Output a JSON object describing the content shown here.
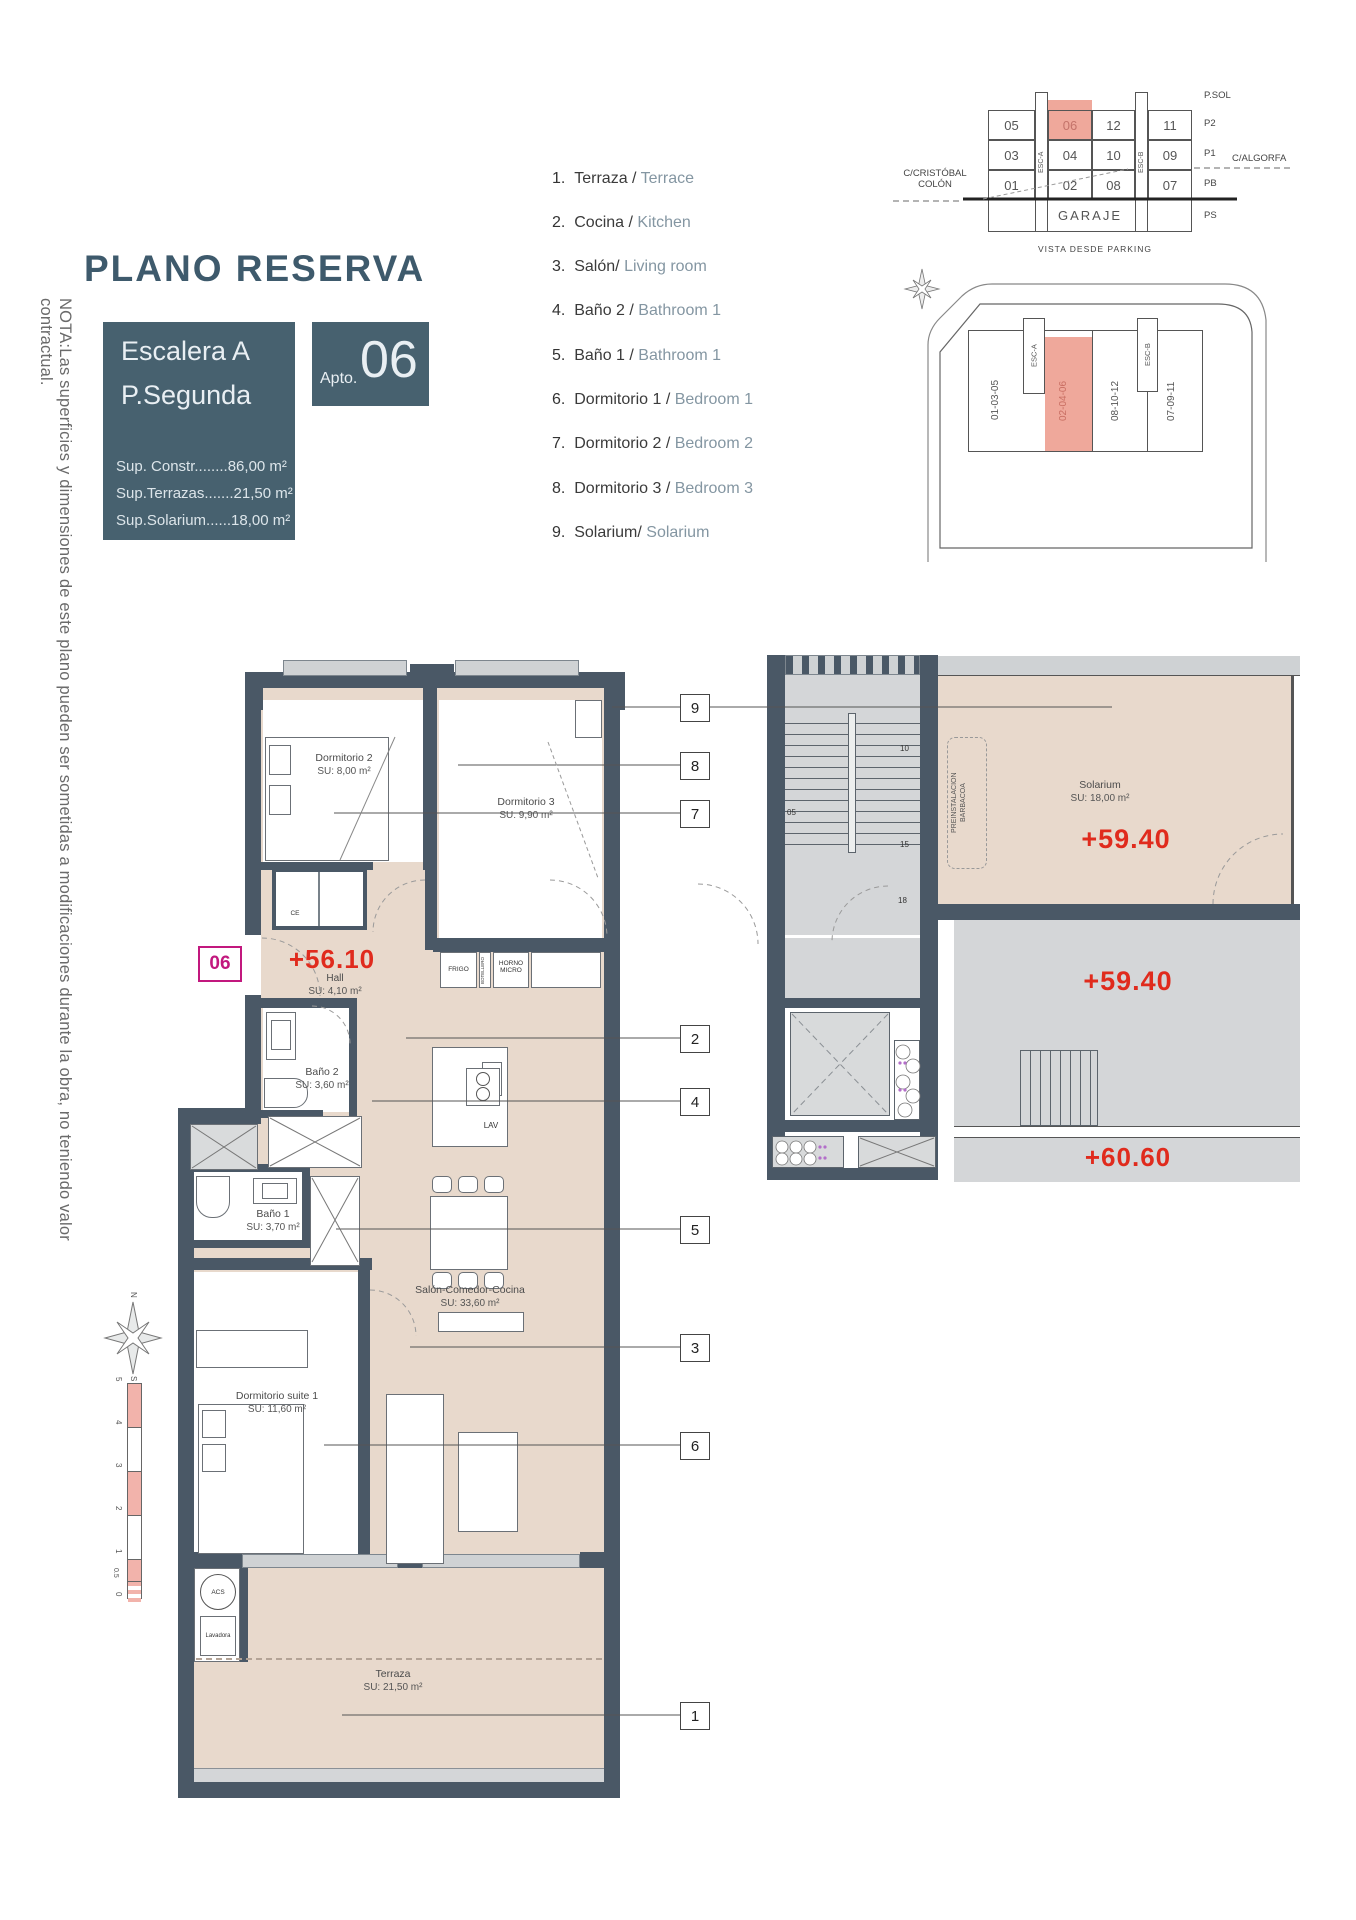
{
  "header": {
    "title": "PLANO RESERVA",
    "stair_block": {
      "line1": "Escalera A",
      "line2": "P.Segunda"
    },
    "apto": {
      "label": "Apto.",
      "number": "06"
    },
    "areas": [
      "Sup. Constr........86,00 m²",
      "Sup.Terrazas.......21,50 m²",
      "Sup.Solarium......18,00 m²"
    ]
  },
  "legend": {
    "items": [
      {
        "num": "1.",
        "es": "Terraza /",
        "en": "Terrace"
      },
      {
        "num": "2.",
        "es": "Cocina /",
        "en": "Kitchen"
      },
      {
        "num": "3.",
        "es": "Salón/",
        "en": "Living room"
      },
      {
        "num": "4.",
        "es": "Baño 2 /",
        "en": "Bathroom 1"
      },
      {
        "num": "5.",
        "es": "Baño 1 /",
        "en": "Bathroom 1"
      },
      {
        "num": "6.",
        "es": "Dormitorio 1 /",
        "en": "Bedroom 1"
      },
      {
        "num": "7.",
        "es": "Dormitorio 2 /",
        "en": "Bedroom 2"
      },
      {
        "num": "8.",
        "es": "Dormitorio 3 /",
        "en": "Bedroom 3"
      },
      {
        "num": "9.",
        "es": "Solarium/",
        "en": "Solarium"
      }
    ]
  },
  "parking": {
    "caption": "VISTA DESDE PARKING",
    "garage": "GARAJE",
    "esc_a": "ESC-A",
    "esc_b": "ESC-B",
    "floors": [
      "P.SOL",
      "P2",
      "P1",
      "PB",
      "PS"
    ],
    "street_left": "C/CRISTÓBAL COLÓN",
    "street_right": "C/ALGORFA",
    "rows": [
      [
        "05",
        "06",
        "12",
        "11"
      ],
      [
        "03",
        "04",
        "10",
        "09"
      ],
      [
        "01",
        "02",
        "08",
        "07"
      ]
    ],
    "highlighted_unit": "06"
  },
  "site": {
    "blocks": [
      "01-03-05",
      "02-04-06",
      "08-10-12",
      "07-09-11"
    ],
    "esc_a": "ESC-A",
    "esc_b": "ESC-B",
    "highlighted_block": "02-04-06"
  },
  "note": "NOTA:Las superficies y dimensiones de este plano pueden ser sometidas a modificaciones durante la obra, no teniendo valor contractual.",
  "plan": {
    "unit_badge": "06",
    "levels": {
      "hall": "+56.10",
      "solarium": "+59.40",
      "upper_terrace": "+59.40",
      "stair_top": "+60.60"
    },
    "rooms": {
      "dorm2": {
        "name": "Dormitorio 2",
        "su": "SU: 8,00 m²"
      },
      "dorm3": {
        "name": "Dormitorio 3",
        "su": "SU: 9,90 m²"
      },
      "hall": {
        "name": "Hall",
        "su": "SU: 4,10 m²"
      },
      "bath2": {
        "name": "Baño 2",
        "su": "SU: 3,60 m²"
      },
      "bath1": {
        "name": "Baño 1",
        "su": "SU: 3,70 m²"
      },
      "salon": {
        "name": "Salón-Comedor-Cocina",
        "su": "SU: 33,60 m²"
      },
      "suite": {
        "name": "Dormitorio suite 1",
        "su": "SU: 11,60 m²"
      },
      "terraza": {
        "name": "Terraza",
        "su": "SU: 21,50 m²"
      },
      "solarium": {
        "name": "Solarium",
        "su": "SU: 18,00 m²"
      }
    },
    "fixtures": {
      "frigo": "FRIGO",
      "botellero": "BOTELLERO",
      "horno": "HORNO MICRO",
      "lav": "LAV",
      "ce": "CE",
      "acs": "ACS",
      "lavadora": "Lavadora",
      "barbacoa_line1": "PREINSTALACION",
      "barbacoa_line2": "BARBACOA"
    },
    "stair_steps": [
      "05",
      "10",
      "15",
      "18"
    ],
    "callouts": [
      "9",
      "8",
      "7",
      "2",
      "4",
      "5",
      "3",
      "6",
      "1"
    ],
    "compass": {
      "n": "N",
      "s": "S"
    },
    "scale_labels": [
      "5",
      "4",
      "3",
      "2",
      "1",
      "0.5",
      "0"
    ]
  },
  "colors": {
    "slate": "#47616F",
    "wall": "#4A5866",
    "pink": "#EFA89B",
    "red": "#E02B1D",
    "magenta": "#C2187E",
    "beige": "#E8D9CC",
    "gray": "#D4D6D8"
  }
}
